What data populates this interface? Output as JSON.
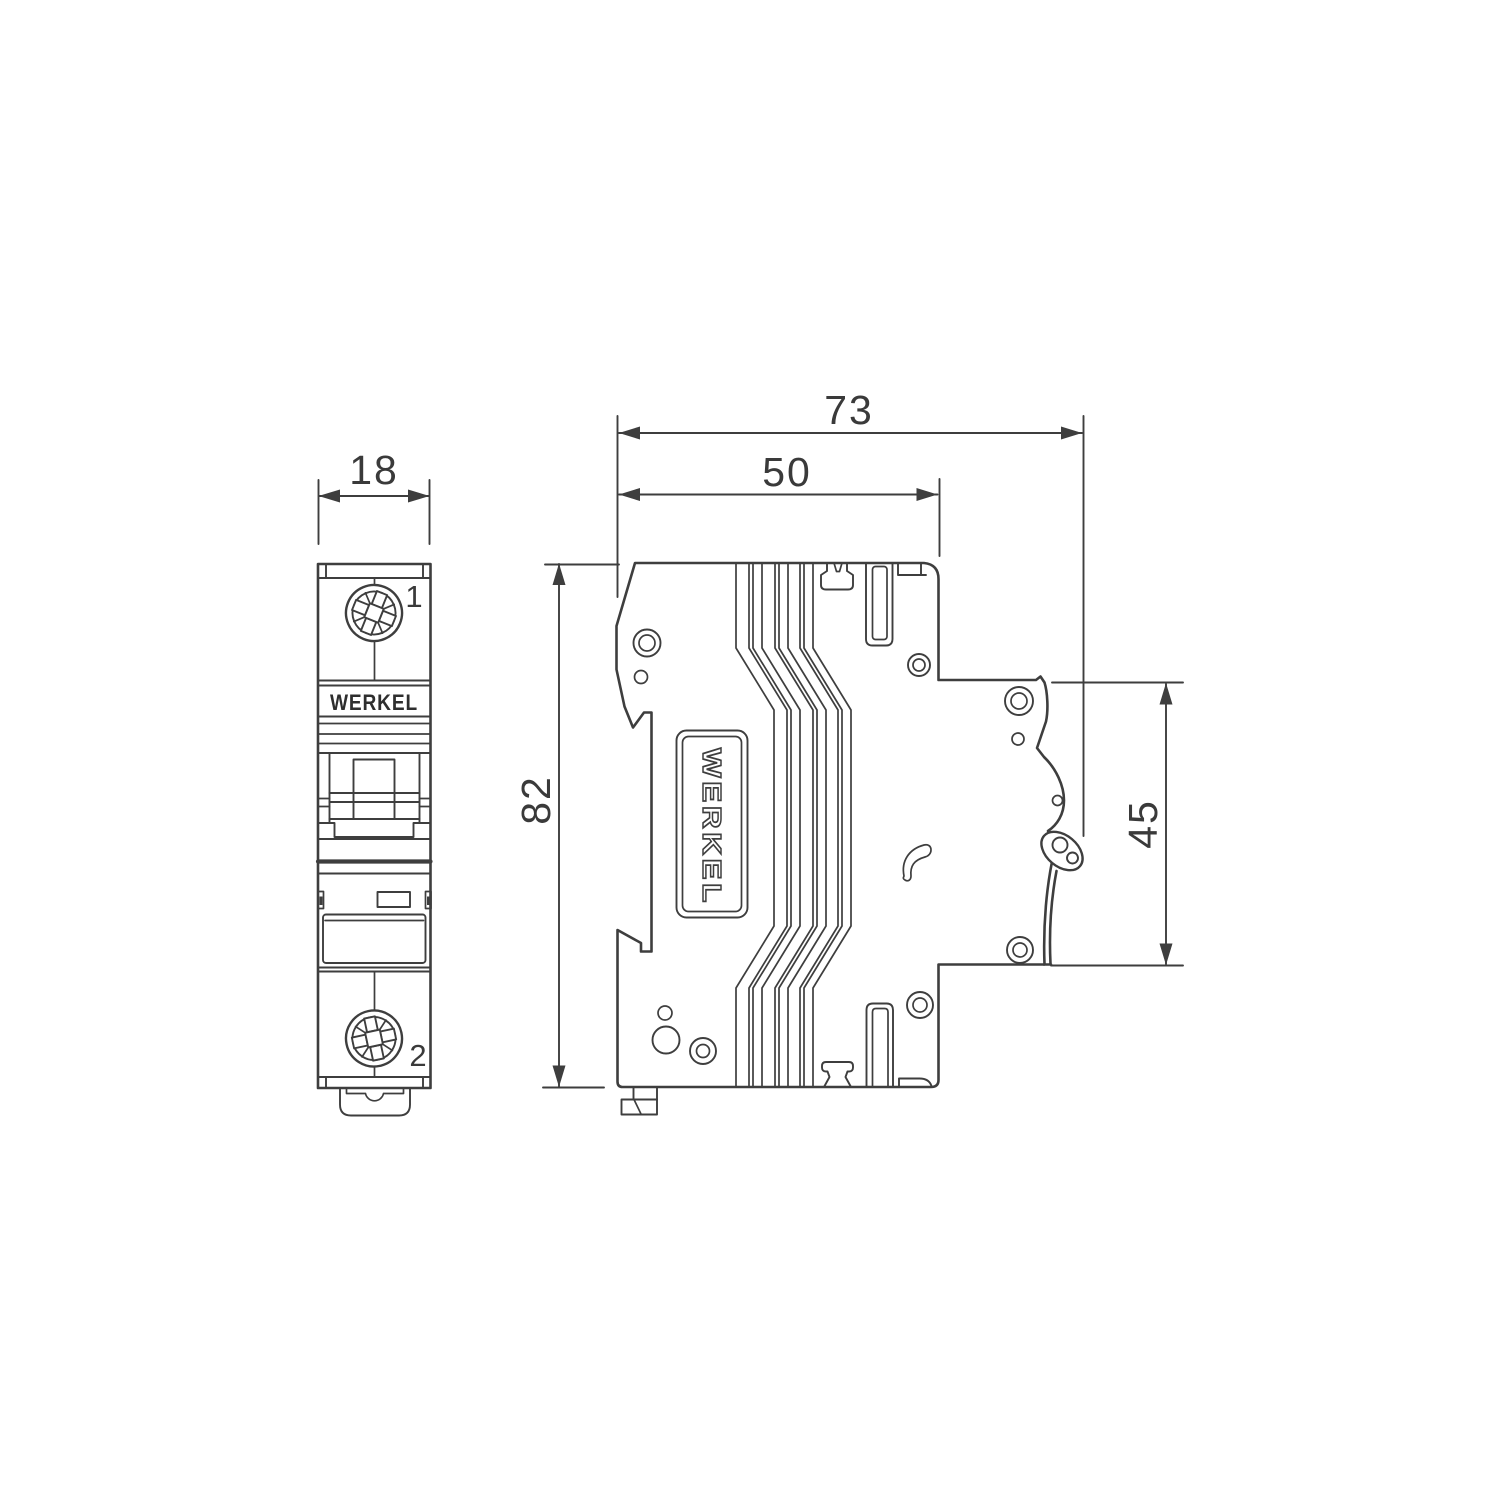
{
  "drawing": {
    "brand": "WERKEL",
    "type_note": "dimensional drawing of 1-pole modular circuit breaker, front and side views",
    "dimensions": {
      "front_width_mm": "18",
      "total_depth_mm": "73",
      "body_depth_mm": "50",
      "height_mm": "82",
      "front_protrusion_mm": "45"
    },
    "front_view": {
      "brand_label": "WERKEL",
      "terminal_top": "1",
      "terminal_bottom": "2"
    },
    "side_view": {
      "brand_label": "WERKEL"
    },
    "colors": {
      "line": "#3e3e3e",
      "text": "#3a3a3a",
      "background": "#ffffff"
    }
  }
}
